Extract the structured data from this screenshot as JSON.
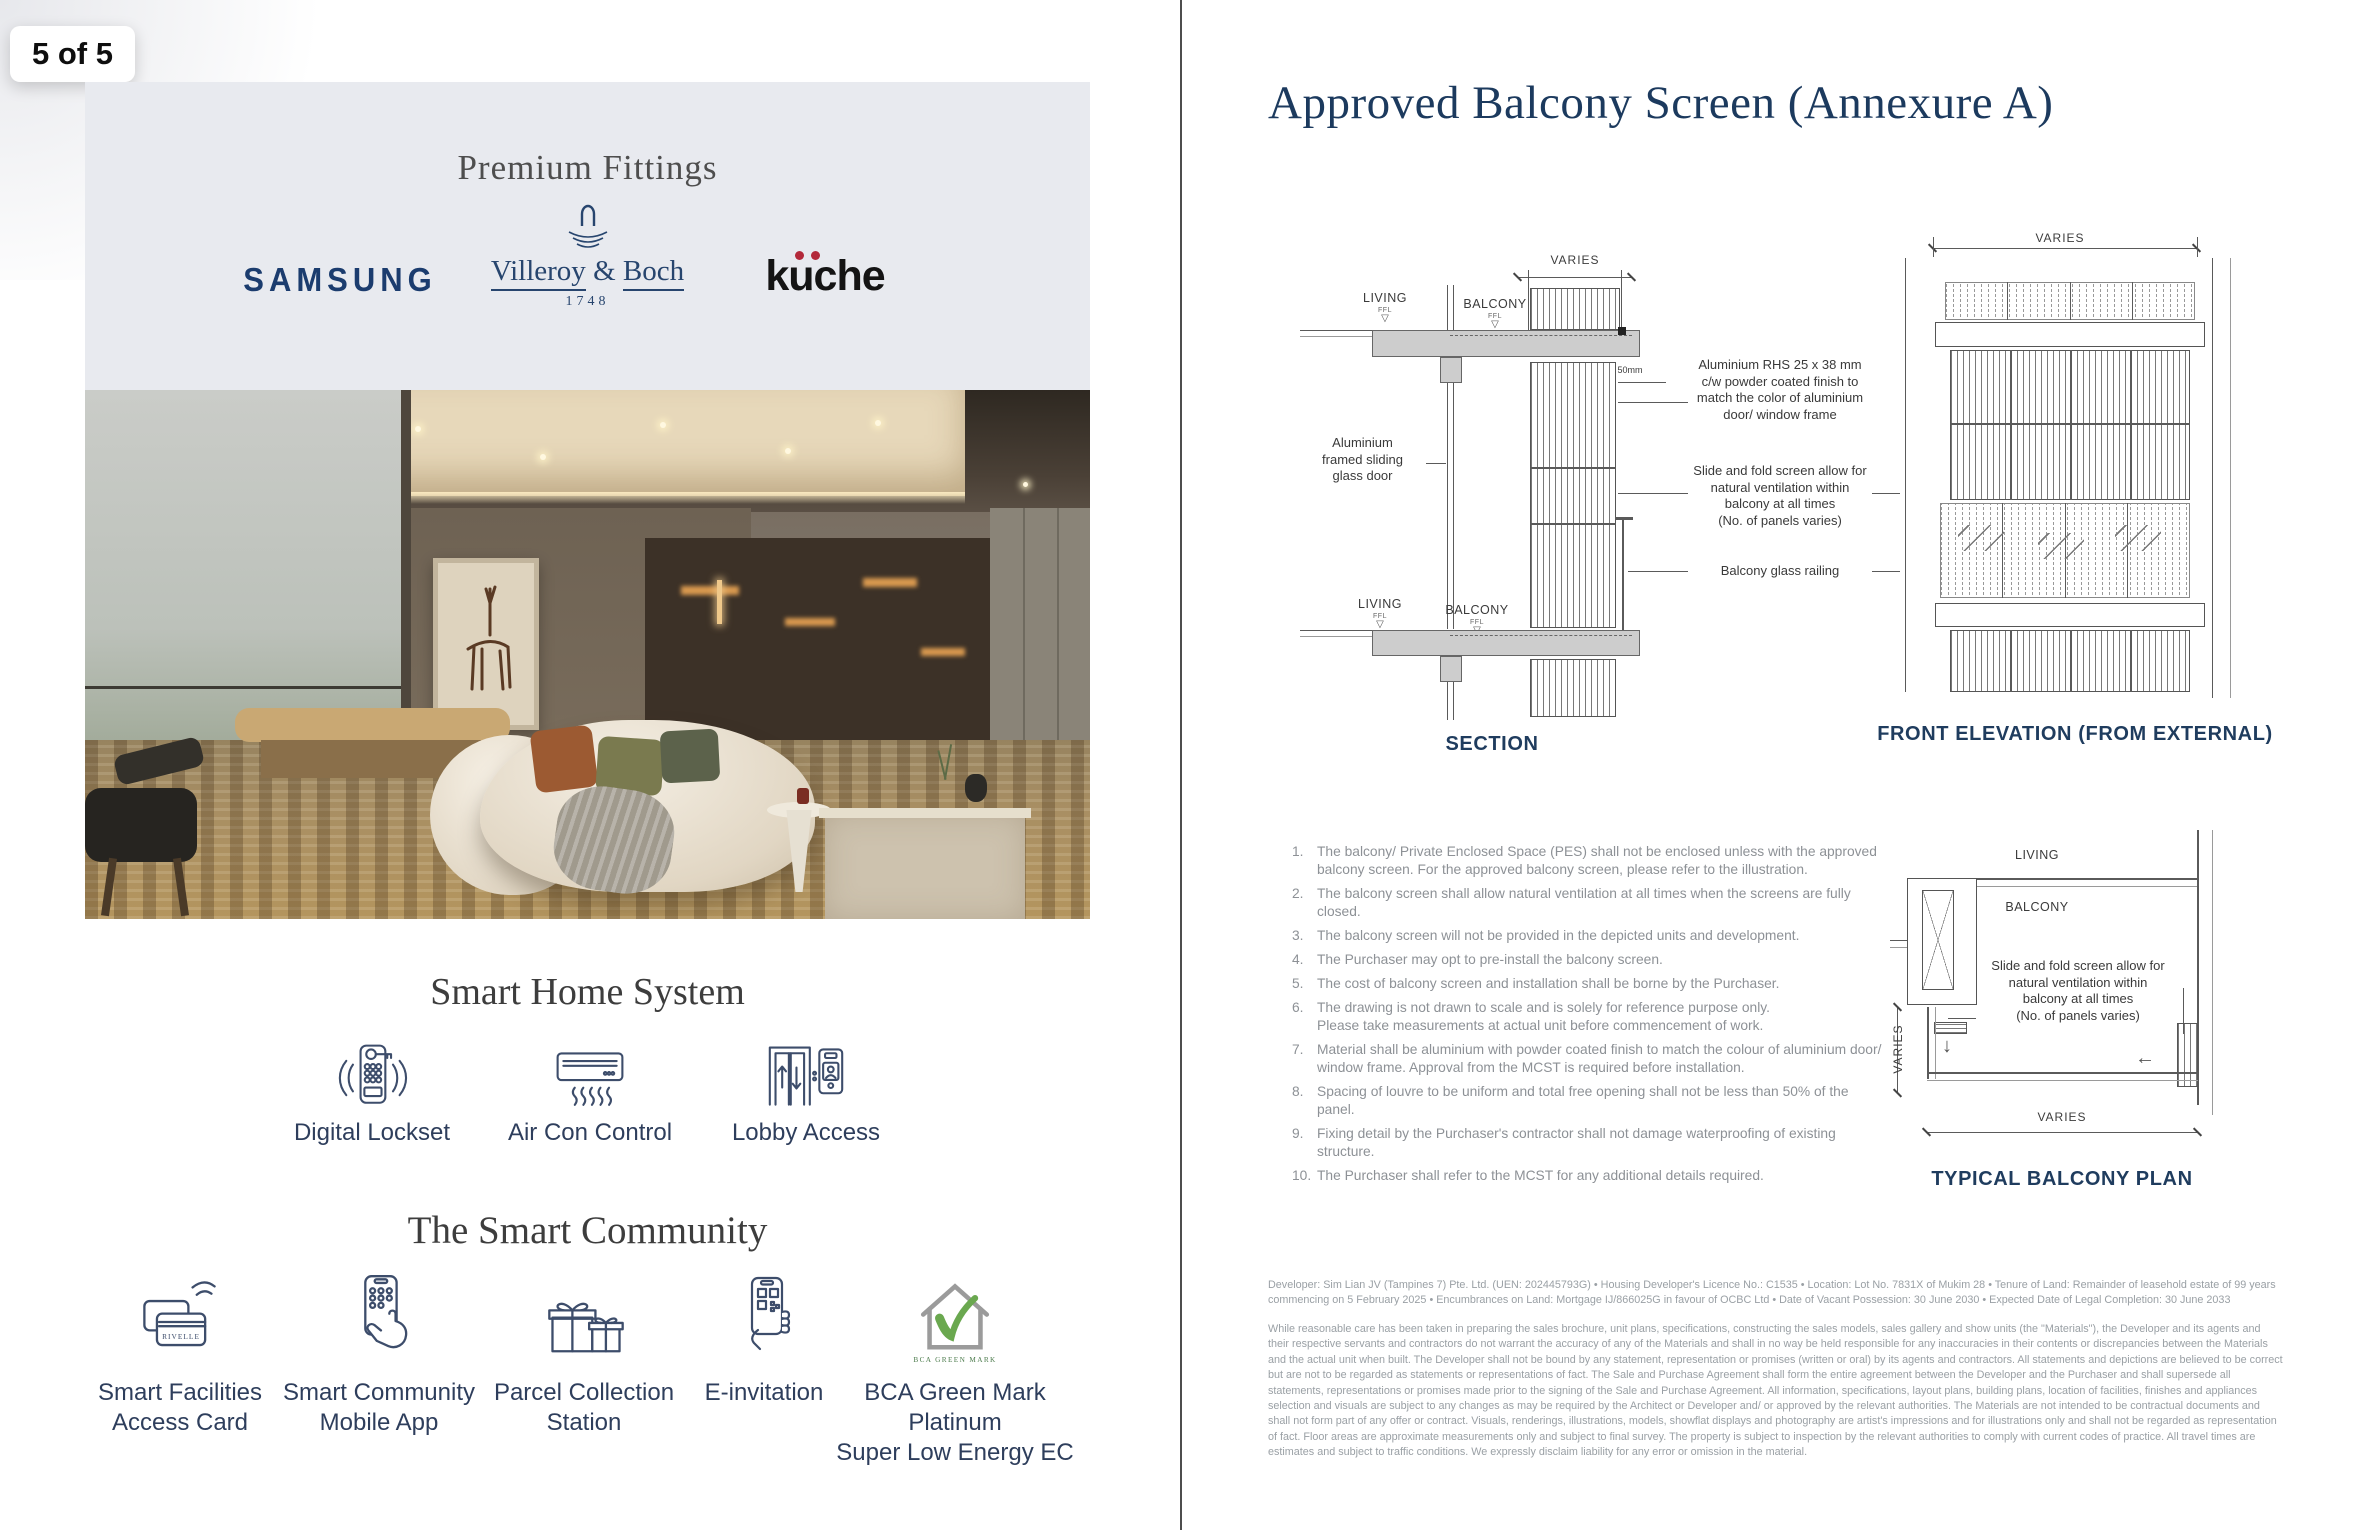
{
  "page_indicator": "5 of 5",
  "colors": {
    "navy": "#1c3a5e",
    "label_navy": "#2e3e5c",
    "samsung_blue": "#1b3c6e",
    "kuche_red": "#b3293a",
    "green_mark": "#6aa84f",
    "panel_bg": "#e8eaef"
  },
  "left_page": {
    "premium_fittings": {
      "title": "Premium Fittings",
      "samsung": "SAMSUNG",
      "villeroy": {
        "word1": "Villeroy",
        "amp": "&",
        "word2": "Boch",
        "year": "1748"
      },
      "kuche": {
        "name": "küche",
        "base": "kuche"
      }
    },
    "smart_home": {
      "title": "Smart Home System",
      "items": [
        {
          "icon": "digital-lockset-icon",
          "label": "Digital Lockset"
        },
        {
          "icon": "aircon-icon",
          "label": "Air Con Control"
        },
        {
          "icon": "lobby-access-icon",
          "label": "Lobby Access"
        }
      ]
    },
    "smart_community": {
      "title": "The Smart Community",
      "items": [
        {
          "icon": "access-card-icon",
          "label1": "Smart Facilities",
          "label2": "Access Card",
          "card_text": "RIVELLE"
        },
        {
          "icon": "mobile-app-icon",
          "label1": "Smart Community",
          "label2": "Mobile App"
        },
        {
          "icon": "parcel-icon",
          "label1": "Parcel Collection",
          "label2": "Station"
        },
        {
          "icon": "e-invitation-icon",
          "label1": "E-invitation",
          "label2": ""
        },
        {
          "icon": "green-mark-icon",
          "label1": "BCA Green Mark Platinum",
          "label2": "Super Low Energy EC",
          "logo_text": "BCA GREEN MARK"
        }
      ]
    }
  },
  "right_page": {
    "title": "Approved Balcony Screen (Annexure A)",
    "section": {
      "label": "SECTION",
      "dim": "VARIES",
      "living": "LIVING",
      "balcony": "BALCONY",
      "ffl": "FFL",
      "dim_small": "50mm",
      "anno_left": "Aluminium\nframed sliding\nglass door",
      "anno_rhs": "Aluminium RHS 25 x 38 mm\nc/w powder coated finish to\nmatch the color of aluminium\ndoor/ window frame",
      "anno_slide": "Slide and fold screen allow for\nnatural ventilation within\nbalcony at all times\n(No. of panels varies)",
      "anno_railing": "Balcony glass railing"
    },
    "elevation": {
      "label": "FRONT ELEVATION (FROM EXTERNAL)",
      "dim": "VARIES"
    },
    "plan": {
      "label": "TYPICAL BALCONY PLAN",
      "living": "LIVING",
      "balcony": "BALCONY",
      "dim_left": "VARIES",
      "dim_bottom": "VARIES",
      "anno": "Slide and fold screen allow for\nnatural ventilation within\nbalcony at all times\n(No. of panels varies)"
    },
    "notes": [
      {
        "num": "1.",
        "text": "The balcony/ Private Enclosed Space (PES) shall not be enclosed unless with the approved balcony screen. For the approved balcony screen, please refer to the illustration."
      },
      {
        "num": "2.",
        "text": "The balcony screen shall allow natural ventilation at all times when the screens are fully closed."
      },
      {
        "num": "3.",
        "text": "The balcony screen will not be provided in the depicted units and development."
      },
      {
        "num": "4.",
        "text": "The Purchaser may opt to pre-install the balcony screen."
      },
      {
        "num": "5.",
        "text": "The cost of balcony screen and installation shall be borne by the Purchaser."
      },
      {
        "num": "6.",
        "text": "The drawing is not drawn to scale and is solely for reference purpose only.\nPlease take measurements at actual unit before commencement of work."
      },
      {
        "num": "7.",
        "text": "Material shall be aluminium with powder coated finish to match the colour of aluminium door/ window frame. Approval from the MCST is required before installation."
      },
      {
        "num": "8.",
        "text": "Spacing of louvre to be uniform and total free opening shall not be less than 50% of the panel."
      },
      {
        "num": "9.",
        "text": "Fixing detail by the Purchaser's contractor shall not damage waterproofing of existing structure."
      },
      {
        "num": "10.",
        "text": "The Purchaser shall refer to the MCST for any additional details required."
      }
    ],
    "developer_info": "Developer: Sim Lian JV (Tampines 7) Pte. Ltd. (UEN: 202445793G) • Housing Developer's Licence No.: C1535 • Location: Lot No. 7831X of Mukim 28 • Tenure of Land: Remainder of leasehold estate of 99 years commencing on 5 February 2025 • Encumbrances on Land: Mortgage IJ/866025G in favour of OCBC Ltd • Date of Vacant Possession: 30 June 2030 • Expected Date of Legal Completion: 30 June 2033",
    "disclaimer": "While reasonable care has been taken in preparing the sales brochure, unit plans, specifications, constructing the sales models, sales gallery and show units (the \"Materials\"), the Developer and its agents and their respective servants and contractors do not warrant the accuracy of any of the Materials and shall in no way be held responsible for any inaccuracies in their contents or discrepancies between the Materials and the actual unit when built. The Developer shall not be bound by any statement, representation or promises (written or oral) by its agents and contractors. All statements and depictions are believed to be correct but are not to be regarded as statements or representations of fact. The Sale and Purchase Agreement shall form the entire agreement between the Developer and the Purchaser and shall supersede all statements, representations or promises made prior to the signing of the Sale and Purchase Agreement. All information, specifications, layout plans, building plans, location of facilities, finishes and appliances selection and visuals are subject to any changes as may be required by the Architect or Developer and/ or approved by the relevant authorities. The Materials are not intended to be contractual documents and shall not form part of any offer or contract. Visuals, renderings, illustrations, models, showflat displays and photography are artist's impressions and for illustrations only and shall not be regarded as representation of fact. Floor areas are approximate measurements only and subject to final survey. The property is subject to inspection by the relevant authorities to comply with current codes of practice. All travel times are estimates and subject to traffic conditions. We expressly disclaim liability for any error or omission in the material."
  }
}
